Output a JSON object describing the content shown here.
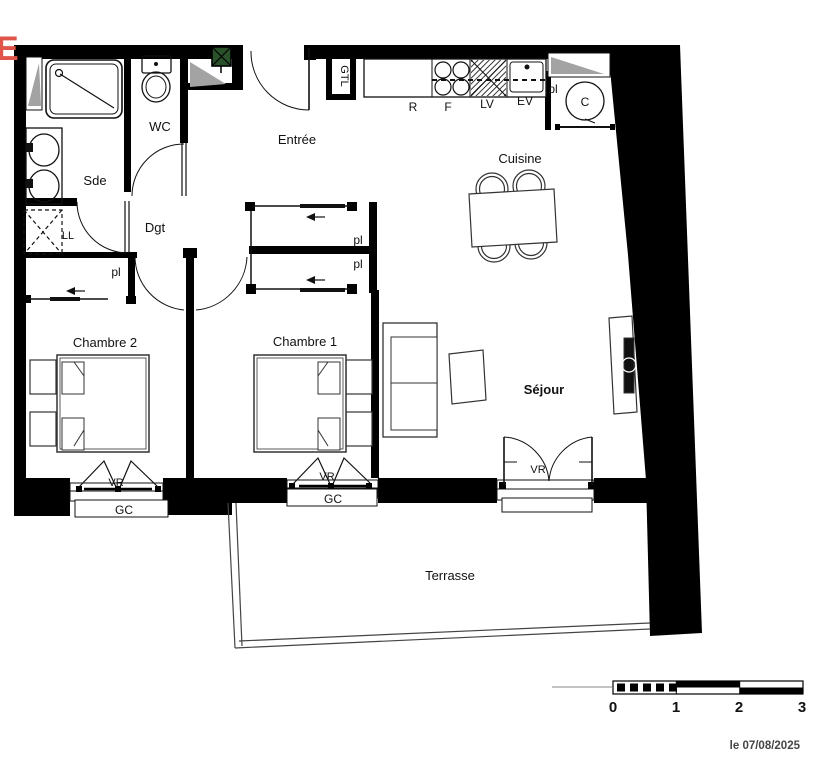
{
  "annotation": {
    "street_letter": "E"
  },
  "plan": {
    "rooms": {
      "sde": "Sde",
      "wc": "WC",
      "entree": "Entrée",
      "dgt": "Dgt",
      "cuisine": "Cuisine",
      "chambre2": "Chambre 2",
      "chambre1": "Chambre 1",
      "sejour": "Séjour",
      "terrasse": "Terrasse"
    },
    "equipment": {
      "gtl": "GTL",
      "washer": "LL",
      "water_heater": "C",
      "fridge": "R",
      "oven": "F",
      "dishwasher": "LV",
      "sink": "EV"
    },
    "tags": {
      "closet": "pl",
      "roller_shutter": "VR",
      "guardrail": "GC"
    }
  },
  "scale_bar": {
    "ticks": [
      "0",
      "1",
      "2",
      "3"
    ]
  },
  "footer": {
    "date_label": "le 07/08/2025"
  },
  "colors": {
    "wall": "#000000",
    "sill_gray": "#a3a3a3",
    "duct_green": "#2a522a",
    "street_red": "#e0544a",
    "text": "#111111",
    "date_text": "#454545"
  }
}
